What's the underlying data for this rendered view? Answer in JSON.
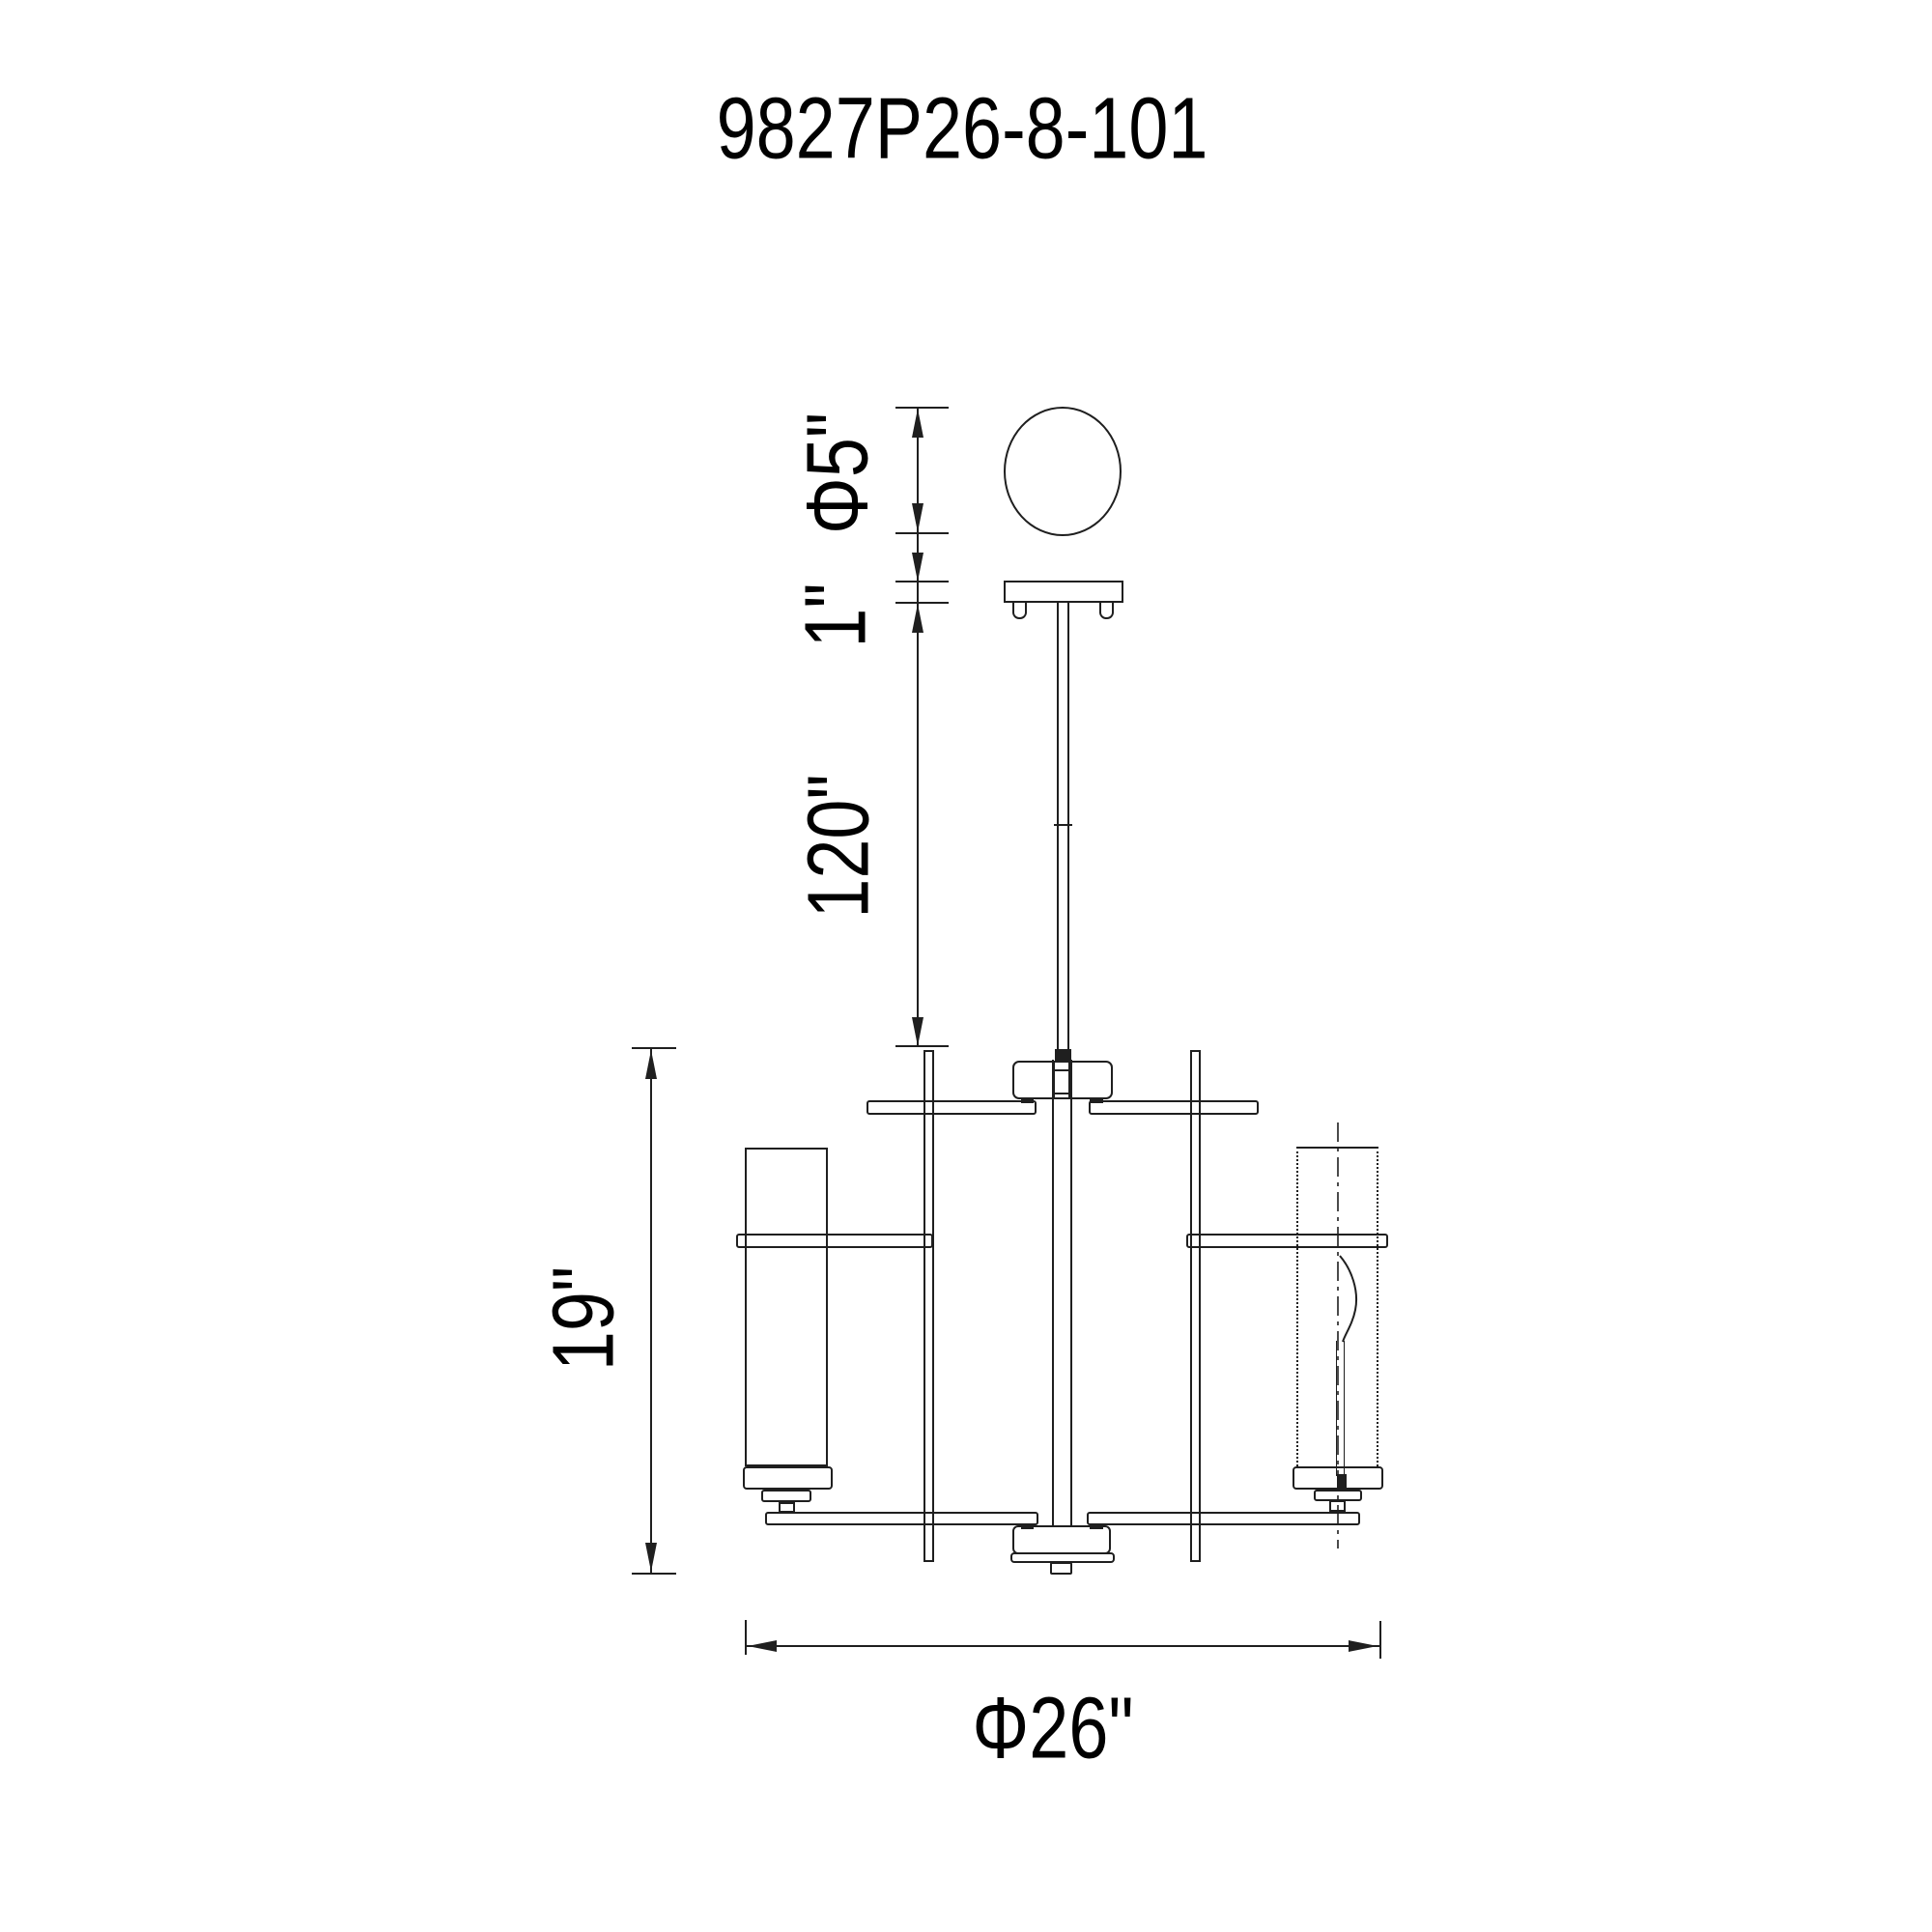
{
  "title": "9827P26-8-101",
  "colors": {
    "line_color": "#1f1f1f",
    "background": "#ffffff",
    "text_color": "#000000"
  },
  "dimensions": {
    "canopy_diameter": "Φ5\"",
    "canopy_thickness": "1\"",
    "suspension_length": "120\"",
    "body_height": "19\"",
    "body_diameter": "Φ26\""
  }
}
